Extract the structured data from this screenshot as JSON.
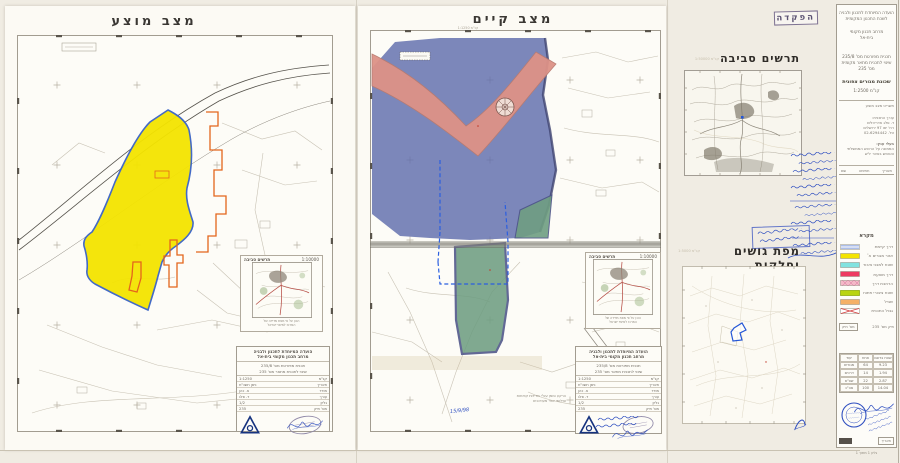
{
  "colors": {
    "yellow": "#f4e400",
    "blue_zone": "#5f6cac",
    "salmon": "#dd9287",
    "green_zone": "#6f9e82",
    "cyan": "#82e2df",
    "red": "#ee3a62",
    "pink_hatch": "#f4b9c8",
    "lime": "#b9d411",
    "orange": "#f5b066",
    "orange_line": "#e4651c",
    "plan_border_blue": "#3a63c4",
    "ink_blue": "#2f4fc0",
    "logo_blue": "#16337f",
    "dash_blue": "#2b5fe0"
  },
  "panels": {
    "proposed": {
      "title": "מצב מוצע"
    },
    "existing": {
      "title": "מצב קיים",
      "scale_note": "קנ\"מ 1:1250"
    }
  },
  "deposit_stamp": {
    "label": "הפקדה"
  },
  "env_diagram": {
    "title": "תרשים סביבה",
    "scale": "קנ\"מ 1:50000"
  },
  "parcels_map": {
    "title": "מפת גושים וחלקות",
    "scale": "קנ\"מ 1:5000"
  },
  "inset": {
    "title": "תרשים סביבה",
    "scale": "1:10000",
    "caption_line1": "הוכן על פי מפת מדידה של",
    "caption_line2": "המרכז למיפוי ישראל"
  },
  "legend": {
    "title": "מקרא",
    "items": [
      {
        "label": "דרך קיימת",
        "color": "#ffffff"
      },
      {
        "label": "אזור מגורים א'",
        "color": "#f4e400"
      },
      {
        "label": "שטח למבני ציבור",
        "color": "#82e2df"
      },
      {
        "label": "דרך מוצעת",
        "color": "#ee3a62"
      },
      {
        "label": "הרחבת דרך",
        "color": "#f4b9c8"
      },
      {
        "label": "שטח ציבורי פתוח",
        "color": "#b9d411"
      },
      {
        "label": "שביל",
        "color": "#f5b066"
      },
      {
        "label": "גבול התכנית",
        "color": "#ffffff"
      }
    ]
  },
  "sidebar": {
    "agency_line1": "הועדה המיוחדת לתכנון ולבניה",
    "agency_line2": "לשכת התכנון המקומית",
    "region_line1": "מרחב תכנון מקומי",
    "region_line2": "בית-אל",
    "plan_line1": "תכנית מפורטת מס' 235/8",
    "plan_line2": "שינוי לתכנית מתאר מקומית",
    "plan_line3": "מס' 235",
    "plan_name": "שכונת מגורים צפונית",
    "scale": "קנ\"מ 1:2500",
    "sheet_label": "תשריט מצב מוצע",
    "arch_line1": "עורך התכנית:",
    "arch_line2": "ד. פלג אדריכלים",
    "address_line": "רח' יפו 97 ירושלים",
    "phone_line": "טל. 02-6294442",
    "owners_label": "בעלי ענין:",
    "owner_line1": "הממונה על הרכוש הממשלתי",
    "owner_line2": "והנטוש באזור יו\"ש",
    "sig_head1": "תאריך",
    "sig_head2": "חתימה",
    "sig_head3": "שם",
    "file_box": "מס' תיק",
    "file_text": "תיק מס' 235",
    "table": {
      "headers": [
        "שטח בדונם",
        "אחוז",
        "יעוד"
      ],
      "rows": [
        [
          "9.23",
          "64",
          "מגורים"
        ],
        [
          "1.94",
          "14",
          "דרכים"
        ],
        [
          "2.87",
          "22",
          "שצ\"פ"
        ]
      ],
      "total": [
        "14.04",
        "100",
        "סה\"כ"
      ]
    },
    "box_date": "תאריך",
    "footer": "גליון 1 מתוך 1"
  },
  "titleblock": {
    "header1": "הועדה המיוחדת לתכנון ולבניה",
    "header2": "מרחב תכנון מקומי בית-אל",
    "line1": "תכנית מפורטת מס' 235/8",
    "line2": "שינוי לתכנית מתאר מס' 235",
    "rows": [
      {
        "label": "קנ\"מ",
        "value": "1:1250"
      },
      {
        "label": "תאריך",
        "value": "ניסן תשנ\"ח"
      },
      {
        "label": "מודד",
        "value": "א. כהן"
      },
      {
        "label": "עורך",
        "value": "ד. פלג"
      },
      {
        "label": "גליון",
        "value": "1/2"
      },
      {
        "label": "מס' תיק",
        "value": "235"
      }
    ]
  },
  "notes": {
    "line1": "הרקע סומן עפ\"י מדידות קודמות",
    "line2": "וצילומי אויר מעודכנים",
    "date": "15/9/98"
  }
}
